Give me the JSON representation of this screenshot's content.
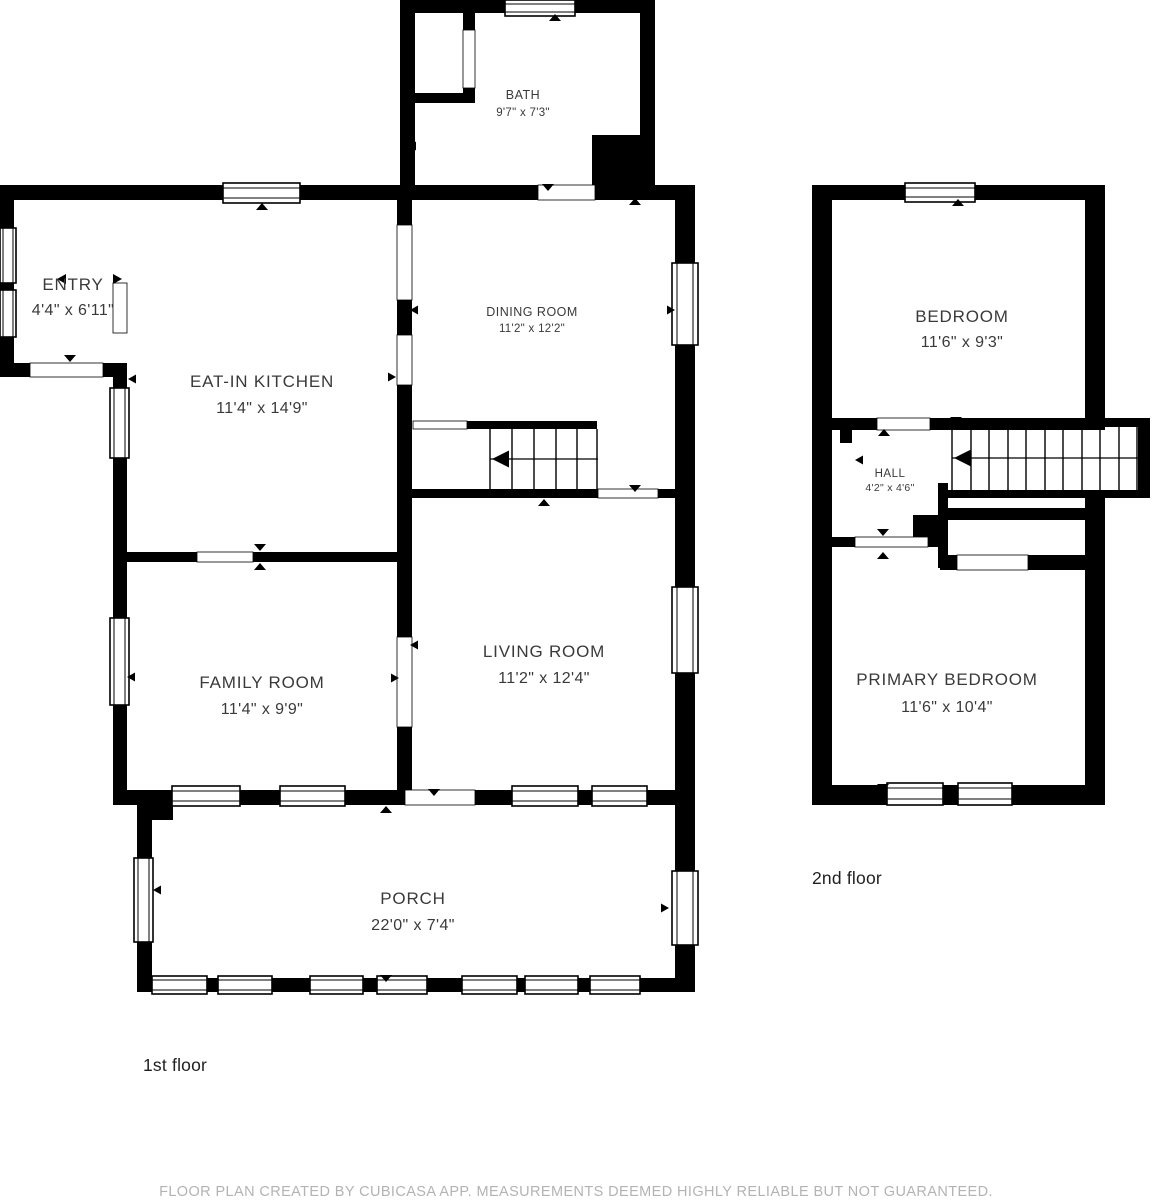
{
  "title": "CubiCasa floor plan",
  "floors": [
    {
      "label": "1st floor",
      "rooms": [
        {
          "name": "BATH",
          "dims": "9'7\" x 7'3\""
        },
        {
          "name": "ENTRY",
          "dims": "4'4\" x 6'11\""
        },
        {
          "name": "EAT-IN KITCHEN",
          "dims": "11'4\" x 14'9\""
        },
        {
          "name": "DINING ROOM",
          "dims": "11'2\" x 12'2\""
        },
        {
          "name": "FAMILY ROOM",
          "dims": "11'4\" x 9'9\""
        },
        {
          "name": "LIVING ROOM",
          "dims": "11'2\" x 12'4\""
        },
        {
          "name": "PORCH",
          "dims": "22'0\" x 7'4\""
        }
      ]
    },
    {
      "label": "2nd floor",
      "rooms": [
        {
          "name": "BEDROOM",
          "dims": "11'6\" x 9'3\""
        },
        {
          "name": "HALL",
          "dims": "4'2\" x 4'6\""
        },
        {
          "name": "PRIMARY BEDROOM",
          "dims": "11'6\" x 10'4\""
        }
      ]
    }
  ],
  "footer": "FLOOR PLAN CREATED BY CUBICASA APP. MEASUREMENTS DEEMED HIGHLY RELIABLE BUT NOT GUARANTEED.",
  "colors": {
    "wall": "#000000",
    "background": "#ffffff",
    "room_label": "#3a3a3a",
    "floor_label": "#1f1f1f",
    "footer_text": "#b3b3b3"
  }
}
